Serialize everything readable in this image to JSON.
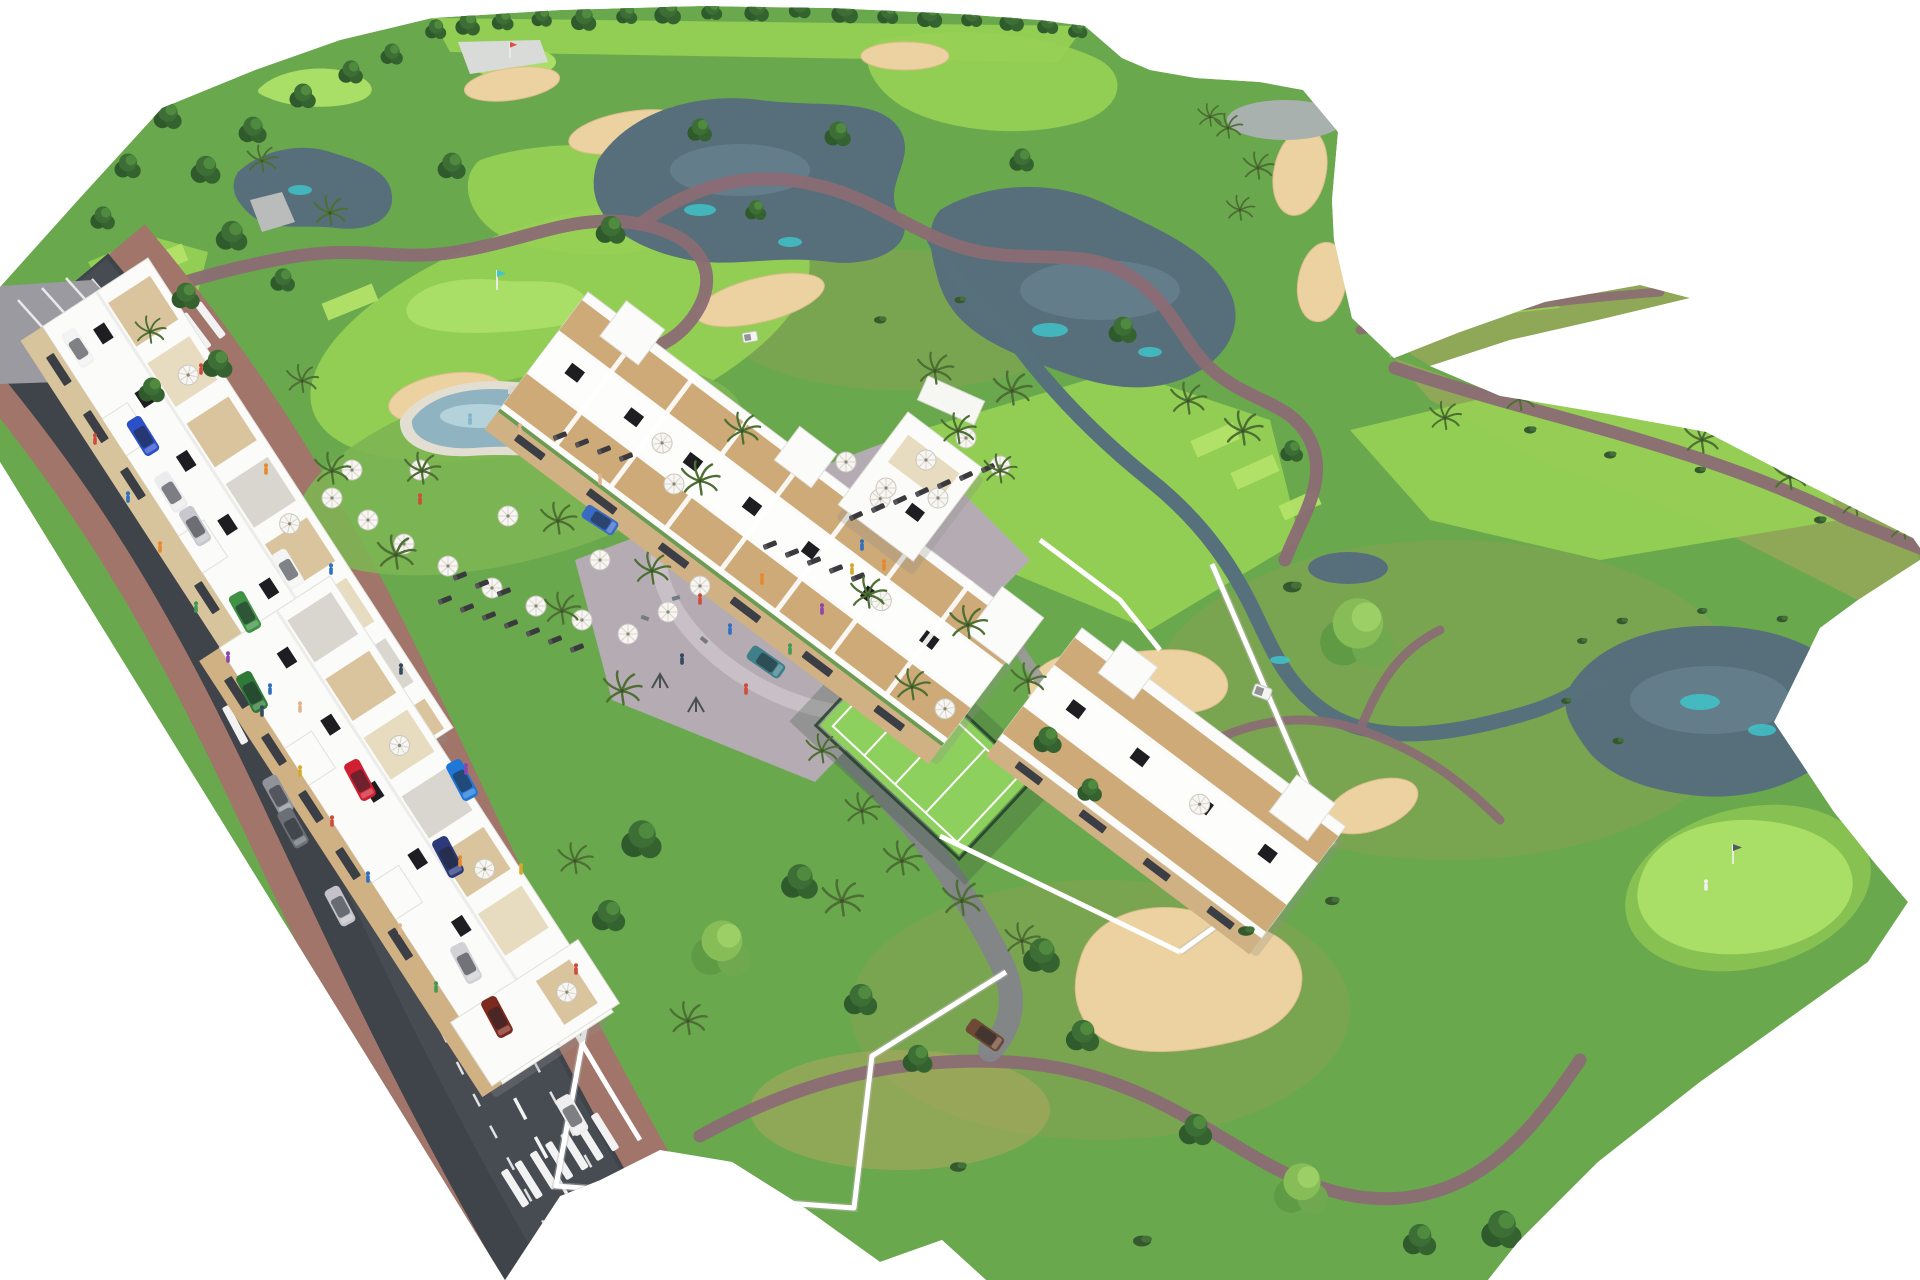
{
  "image": {
    "kind": "3D aerial architectural rendering",
    "subject": "Golf-resort residential masterplan: white apartment blocks with rooftop terraces, lagoon pool, padel court and playground beside a golf course with lakes, sand bunkers, winding cart paths and palm trees; diagonal access road with traffic at lower left",
    "background_color": "#ffffff",
    "width_px": 1920,
    "height_px": 1280,
    "visible_text": "none"
  },
  "palette": {
    "background": "#ffffff",
    "grass_base": "#6aa84e",
    "fairway_light": "#97d155",
    "green_putting": "#a9de67",
    "rough_dry": "#a8a45f",
    "tree_dark": "#2f5a2b",
    "tree_light": "#6fa84e",
    "palm_frond": "#4d6f33",
    "water_deep": "#566f7b",
    "water_teal": "#3fc3c9",
    "sand": "#ecd2a0",
    "cart_path": "#8b6b74",
    "road_asphalt": "#3f434a",
    "road_marking": "#f2f2f2",
    "sidewalk": "#a1756a",
    "plaza_paving": "#b5abb3",
    "building_white": "#fbfbf9",
    "facade_beige": "#d8c49c",
    "pergola_tan": "#c9a36b",
    "panel_black": "#1e1e22",
    "pool_water": "#8fb3c1",
    "pool_deck": "#e3ded2",
    "padel_court": "#8ed05e",
    "wall_white": "#ffffff"
  },
  "golf_course": {
    "lakes_count": 5,
    "grey_pond_count": 1,
    "sand_bunkers_count": 11,
    "putting_greens_count": 3,
    "flags_count": 3,
    "tee_boxes_count": 7,
    "fairway_patches_count": 8,
    "cart_paths_count": 6,
    "creeks": "stream linking lakes with turquoise shallows",
    "golfer_on_green": 1,
    "golf_carts_count": 2,
    "tree_line": "row of trees along the top edge of the site"
  },
  "road": {
    "orientation": "diagonal from upper-left to lower-center",
    "marking": "white dashed lane lines",
    "crosswalks_count": 3,
    "parked_cars_count": 8,
    "moving_cars_count": 9,
    "car_colors": [
      "white",
      "blue",
      "silver",
      "red",
      "green",
      "dark-red",
      "teal",
      "brown",
      "navy",
      "grey"
    ],
    "pedestrians_count": 30,
    "entry_gate": "white pillars with dark gate by the wall"
  },
  "buildings": {
    "blocks_count": 4,
    "style": "modern white apartment slabs with beige balcony bands and dark window strips",
    "rooftop_features": [
      "terrace decks",
      "white parasols",
      "dark solar panels",
      "tan pergolas",
      "stair towers"
    ],
    "pool_pavilion": 1,
    "perimeter": "white garden walls around private gardens"
  },
  "amenities": {
    "pool": {
      "shape": "lagoon style with pale deck",
      "surroundings": "sun lawn with white parasols, dark sunbeds and bathers"
    },
    "padel_court": {
      "surface": "light green with white lines",
      "fence": "dark green mesh"
    },
    "playground_plaza": {
      "paving": "grey-mauve with curved ring path",
      "features": "outdoor gym, swings and playing people"
    },
    "bike_racks": 1,
    "parasols_count": 29,
    "sunbeds_count": 26
  },
  "vegetation": {
    "deciduous_trees_count": 57,
    "palm_trees_count": 43,
    "bushes_count": 18,
    "garden_band": "dense trees and palms between road wall and buildings"
  }
}
